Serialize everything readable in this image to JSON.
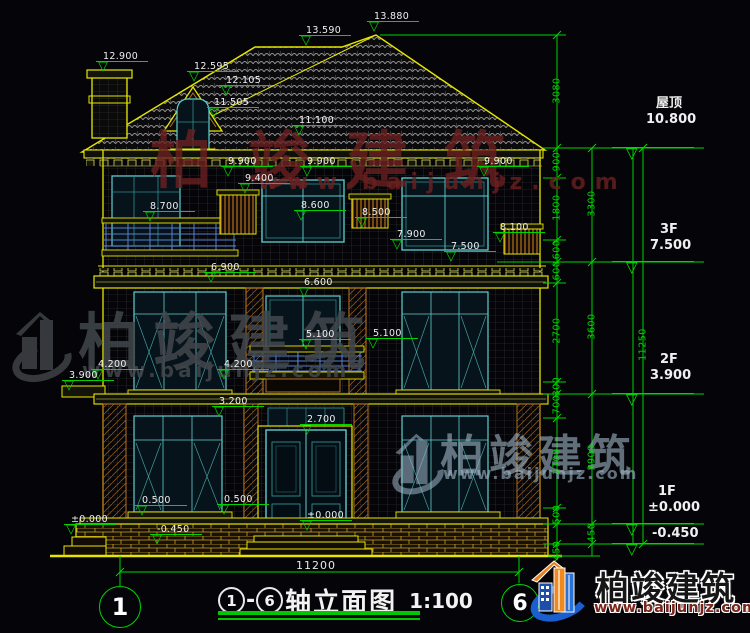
{
  "title": {
    "axis_start": "1",
    "separator": "-",
    "axis_end": "6",
    "name": "轴立面图",
    "scale": "1:100"
  },
  "bottom_dim": "11200",
  "axis_bubbles": {
    "left": "1",
    "right": "6"
  },
  "levels": [
    {
      "name": "屋顶",
      "value": "10.800",
      "x": 633,
      "y": 148,
      "tx": 646,
      "ty": 96
    },
    {
      "name": "3F",
      "value": "7.500",
      "x": 633,
      "y": 262,
      "tx": 650,
      "ty": 222
    },
    {
      "name": "2F",
      "value": "3.900",
      "x": 633,
      "y": 394,
      "tx": 650,
      "ty": 352
    },
    {
      "name": "1F",
      "value": "±0.000",
      "x": 633,
      "y": 524,
      "tx": 648,
      "ty": 484
    },
    {
      "name": "",
      "value": "-0.450",
      "x": 633,
      "y": 544,
      "tx": 652,
      "ty": 526
    }
  ],
  "markers": [
    {
      "t": "12.900",
      "x": 105,
      "y": 62
    },
    {
      "t": "12.595",
      "x": 196,
      "y": 72
    },
    {
      "t": "12.105",
      "x": 228,
      "y": 86
    },
    {
      "t": "11.505",
      "x": 216,
      "y": 108
    },
    {
      "t": "13.590",
      "x": 308,
      "y": 36
    },
    {
      "t": "13.880",
      "x": 376,
      "y": 22
    },
    {
      "t": "11.100",
      "x": 301,
      "y": 126
    },
    {
      "t": "9.900",
      "x": 230,
      "y": 167
    },
    {
      "t": "9.900",
      "x": 309,
      "y": 167
    },
    {
      "t": "9.900",
      "x": 486,
      "y": 167
    },
    {
      "t": "9.400",
      "x": 247,
      "y": 184
    },
    {
      "t": "8.700",
      "x": 152,
      "y": 212
    },
    {
      "t": "8.600",
      "x": 303,
      "y": 211
    },
    {
      "t": "8.500",
      "x": 364,
      "y": 218
    },
    {
      "t": "8.100",
      "x": 502,
      "y": 233
    },
    {
      "t": "7.900",
      "x": 399,
      "y": 240
    },
    {
      "t": "7.500",
      "x": 453,
      "y": 252
    },
    {
      "t": "6.900",
      "x": 213,
      "y": 273
    },
    {
      "t": "6.600",
      "x": 306,
      "y": 288
    },
    {
      "t": "5.100",
      "x": 308,
      "y": 340
    },
    {
      "t": "5.100",
      "x": 375,
      "y": 339
    },
    {
      "t": "4.200",
      "x": 100,
      "y": 370
    },
    {
      "t": "4.200",
      "x": 226,
      "y": 370
    },
    {
      "t": "3.900",
      "x": 71,
      "y": 381
    },
    {
      "t": "3.200",
      "x": 221,
      "y": 407
    },
    {
      "t": "2.700",
      "x": 309,
      "y": 425
    },
    {
      "t": "0.500",
      "x": 144,
      "y": 506
    },
    {
      "t": "0.500",
      "x": 226,
      "y": 505
    },
    {
      "t": "±0.000",
      "x": 309,
      "y": 521
    },
    {
      "t": "±0.000",
      "x": 73,
      "y": 525
    },
    {
      "t": "-0.450",
      "x": 159,
      "y": 535
    }
  ],
  "dims": [
    {
      "t": "3080",
      "x": 557,
      "y": 92
    },
    {
      "t": "900",
      "x": 557,
      "y": 163
    },
    {
      "t": "1800",
      "x": 557,
      "y": 209
    },
    {
      "t": "600",
      "x": 557,
      "y": 251
    },
    {
      "t": "600",
      "x": 557,
      "y": 272
    },
    {
      "t": "2700",
      "x": 557,
      "y": 332
    },
    {
      "t": "300",
      "x": 557,
      "y": 388
    },
    {
      "t": "700",
      "x": 557,
      "y": 406
    },
    {
      "t": "2700",
      "x": 557,
      "y": 463
    },
    {
      "t": "500",
      "x": 557,
      "y": 516
    },
    {
      "t": "450",
      "x": 557,
      "y": 552
    },
    {
      "t": "3300",
      "x": 592,
      "y": 205
    },
    {
      "t": "3600",
      "x": 592,
      "y": 328
    },
    {
      "t": "3900",
      "x": 592,
      "y": 459
    },
    {
      "t": "450",
      "x": 592,
      "y": 534
    },
    {
      "t": "11250",
      "x": 643,
      "y": 346
    }
  ],
  "watermarks": {
    "top": {
      "brand": "柏竣建筑",
      "site": "www.baijunjz.com"
    },
    "left": {
      "brand": "柏竣建筑",
      "site": "www.baijunjz.com"
    },
    "right": {
      "brand": "柏竣建筑",
      "site": "www.baijunjz.com"
    }
  },
  "logo": {
    "brand": "柏竣建筑",
    "site": "www.baijunjz.com"
  },
  "colors": {
    "line_green": "#00d400",
    "line_yellow": "#e6e600",
    "window_cyan": "#5fcfcf",
    "accent_brown": "#b4701e",
    "rail_blue": "#5580cc",
    "wm_red": "#6b2020",
    "wm_gray": "#42474c",
    "wm_blue": "#9fb6c6",
    "logo_blue": "#1a5fd0",
    "logo_orange": "#f08a1e"
  }
}
